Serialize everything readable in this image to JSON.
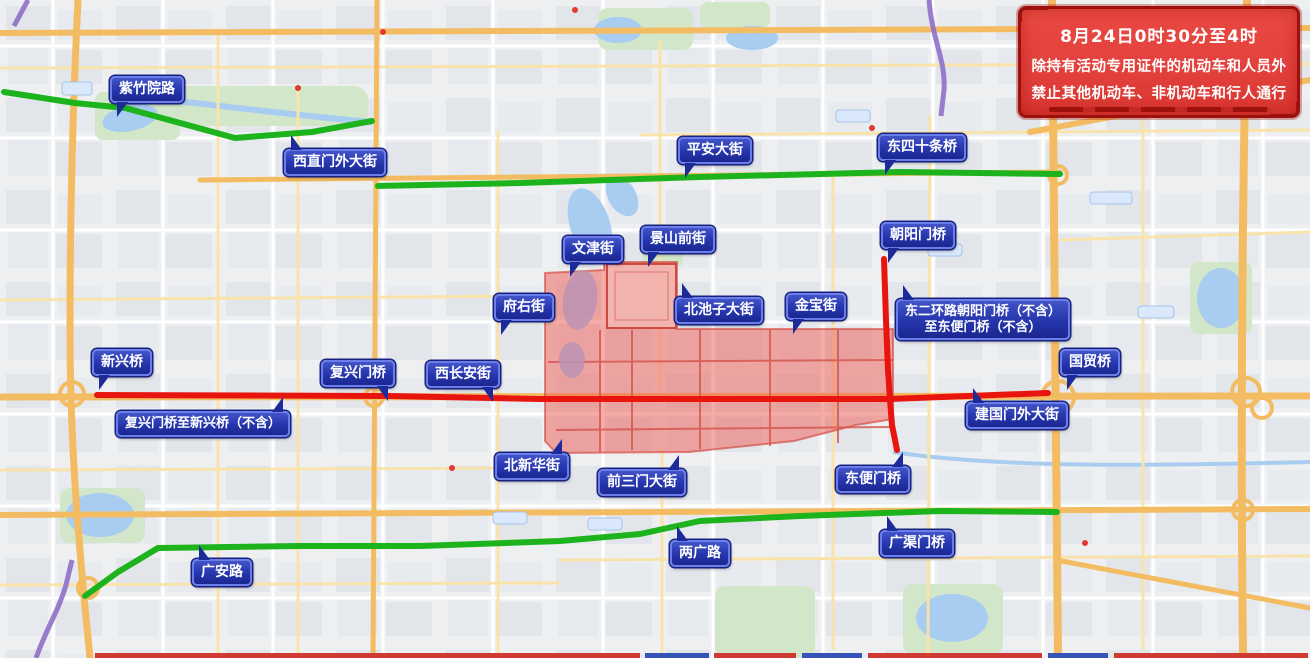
{
  "notice": {
    "line1": "8月24日0时30分至4时",
    "line2": "除持有活动专用证件的机动车和人员外",
    "line3": "禁止其他机动车、非机动车和行人通行"
  },
  "colors": {
    "green_route": "#1db31d",
    "red_route": "#e8150f",
    "zone_fill": "#ed5f58",
    "zone_stroke": "#d23c35",
    "label_bg": "#2535ac",
    "label_bg_dark": "#1d2a99",
    "label_border": "#6a7de8",
    "label_text": "#ffffff",
    "notice_bg": "#e2403c",
    "notice_frame": "#9e100c",
    "notice_text": "#ffffff"
  },
  "zone": {
    "points": "545,273 604,270 604,262 677,262 677,329 893,329 893,419 856,425 794,441 689,452 556,453 545,441"
  },
  "routes": [
    {
      "id": "green-west",
      "kind": "green",
      "points": "4,92 75,103 125,108 235,138 312,132 372,121"
    },
    {
      "id": "green-pingan",
      "kind": "green",
      "points": "378,186 520,183 700,177 900,172 1060,174"
    },
    {
      "id": "green-south",
      "kind": "green",
      "points": "85,596 118,572 158,548 300,546 420,546 560,541 640,534 700,521 800,516 940,511 1057,512"
    },
    {
      "id": "red-changan",
      "kind": "red",
      "points": "97,395 390,396 540,399 700,399 890,399 1048,393"
    },
    {
      "id": "red-second-ring",
      "kind": "red",
      "points": "884,259 886,320 888,370 890,400 892,425 897,450"
    }
  ],
  "labels": [
    {
      "id": "zizhuyuan-lu",
      "lines": [
        "紫竹院路"
      ],
      "x": 110,
      "y": 76,
      "ptr": "bl"
    },
    {
      "id": "xizhimenwai-dajie",
      "lines": [
        "西直门外大街"
      ],
      "x": 284,
      "y": 149,
      "ptr": "tl"
    },
    {
      "id": "pingan-dajie",
      "lines": [
        "平安大街"
      ],
      "x": 678,
      "y": 137,
      "ptr": "bl"
    },
    {
      "id": "dongsishitiao-qiao",
      "lines": [
        "东四十条桥"
      ],
      "x": 878,
      "y": 134,
      "ptr": "bl"
    },
    {
      "id": "wenjin-jie",
      "lines": [
        "文津街"
      ],
      "x": 563,
      "y": 236,
      "ptr": "bl"
    },
    {
      "id": "jingshanqian-jie",
      "lines": [
        "景山前街"
      ],
      "x": 641,
      "y": 226,
      "ptr": "bl"
    },
    {
      "id": "fuyou-jie",
      "lines": [
        "府右街"
      ],
      "x": 494,
      "y": 294,
      "ptr": "bl"
    },
    {
      "id": "beichizi-dajie",
      "lines": [
        "北池子大街"
      ],
      "x": 675,
      "y": 297,
      "ptr": "tl"
    },
    {
      "id": "jinbao-jie",
      "lines": [
        "金宝街"
      ],
      "x": 786,
      "y": 293,
      "ptr": "bl"
    },
    {
      "id": "chaoyangmen-qiao",
      "lines": [
        "朝阳门桥"
      ],
      "x": 881,
      "y": 222,
      "ptr": "bl"
    },
    {
      "id": "dongerhuan-note",
      "lines": [
        "东二环路朝阳门桥（不含）",
        "至东便门桥（不含）"
      ],
      "x": 896,
      "y": 299,
      "ptr": "tl",
      "small": true
    },
    {
      "id": "xinxing-qiao",
      "lines": [
        "新兴桥"
      ],
      "x": 92,
      "y": 349,
      "ptr": "bl"
    },
    {
      "id": "fuxingmen-qiao",
      "lines": [
        "复兴门桥"
      ],
      "x": 321,
      "y": 360,
      "ptr": "br"
    },
    {
      "id": "xichangan-jie",
      "lines": [
        "西长安街"
      ],
      "x": 426,
      "y": 361,
      "ptr": "br"
    },
    {
      "id": "fuxingmen-xinxing-note",
      "lines": [
        "复兴门桥至新兴桥（不含）"
      ],
      "x": 116,
      "y": 411,
      "ptr": "tr",
      "small": true
    },
    {
      "id": "guomao-qiao",
      "lines": [
        "国贸桥"
      ],
      "x": 1060,
      "y": 349,
      "ptr": "bl"
    },
    {
      "id": "jianguomenwai-dajie",
      "lines": [
        "建国门外大街"
      ],
      "x": 966,
      "y": 402,
      "ptr": "tl"
    },
    {
      "id": "beixinhua-jie",
      "lines": [
        "北新华街"
      ],
      "x": 495,
      "y": 453,
      "ptr": "tr"
    },
    {
      "id": "qiansanmen-dajie",
      "lines": [
        "前三门大街"
      ],
      "x": 598,
      "y": 469,
      "ptr": "tr"
    },
    {
      "id": "dongbianmen-qiao",
      "lines": [
        "东便门桥"
      ],
      "x": 836,
      "y": 466,
      "ptr": "tr"
    },
    {
      "id": "liangguang-lu",
      "lines": [
        "两广路"
      ],
      "x": 670,
      "y": 540,
      "ptr": "tl"
    },
    {
      "id": "guangqumen-qiao",
      "lines": [
        "广渠门桥"
      ],
      "x": 880,
      "y": 530,
      "ptr": "tl"
    },
    {
      "id": "guangan-lu",
      "lines": [
        "广安路"
      ],
      "x": 192,
      "y": 559,
      "ptr": "tl"
    }
  ]
}
